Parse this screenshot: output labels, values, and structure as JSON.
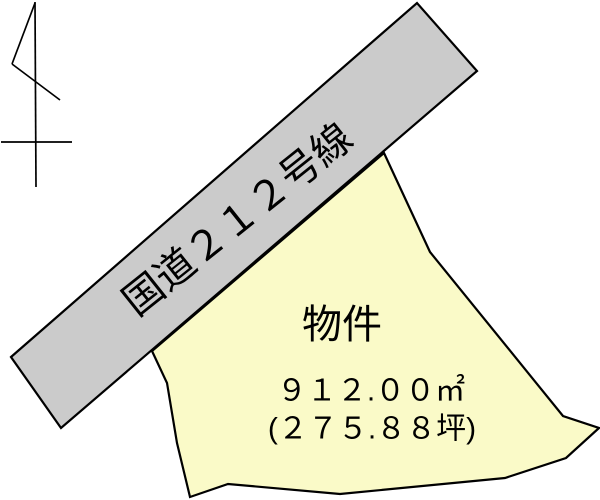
{
  "colors": {
    "background": "#FFFFFF",
    "road_fill": "#CBCBCB",
    "parcel_fill": "#FAFAC8",
    "line": "#000000",
    "text": "#000000"
  },
  "road": {
    "label": "国道２１２号線",
    "route_number": 212
  },
  "parcel": {
    "label": "物件",
    "area_m2_text": "９１２.００㎡",
    "area_m2_value": 912.0,
    "area_tsubo_text": "(２７５.８８坪)",
    "area_tsubo_value": 275.88
  },
  "icons": {
    "north_arrow": "north-arrow-icon"
  }
}
